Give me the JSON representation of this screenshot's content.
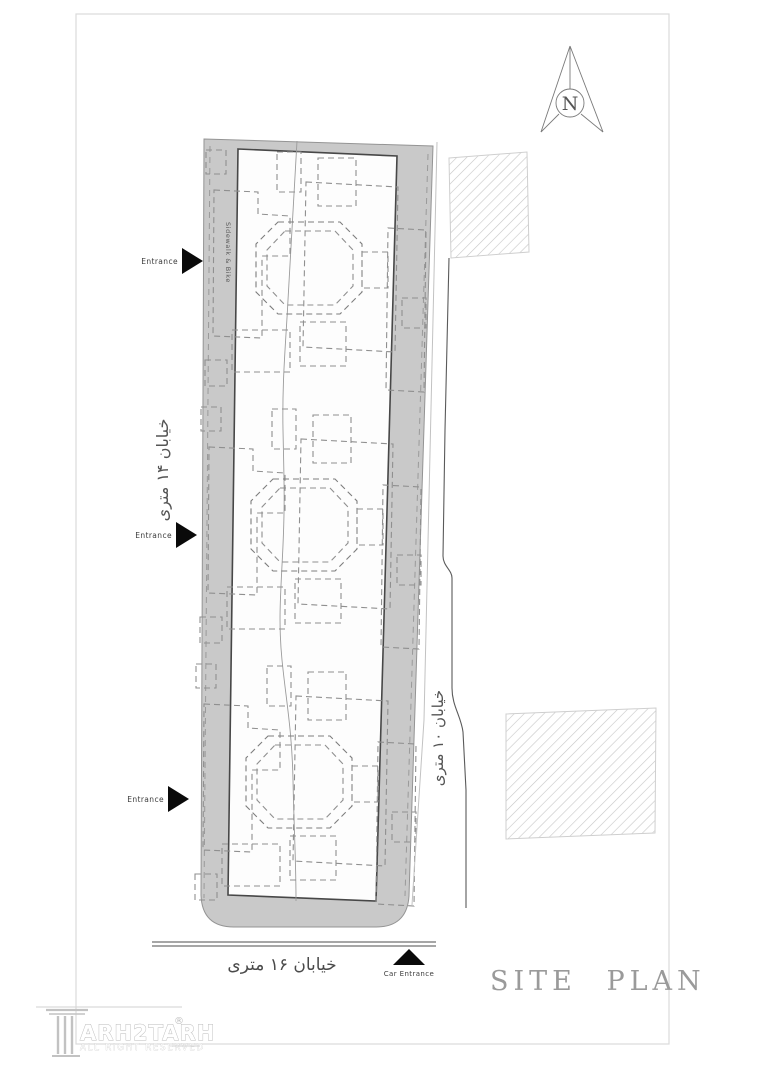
{
  "drawing": {
    "title": "SITE PLAN",
    "compass_label": "N",
    "streets": {
      "left": "خیابان ۱۴ متری",
      "right": "خیابان ۱۰ متری",
      "bottom": "خیابان ۱۶ متری"
    },
    "sidewalk_label": "Sidewalk & Bike",
    "entrances": [
      {
        "label": "Entrance"
      },
      {
        "label": "Entrance"
      },
      {
        "label": "Entrance"
      }
    ],
    "car_entrance_label": "Car Entrance",
    "logo": {
      "name": "ARH2TARH",
      "registered": "®",
      "tagline": "ALL RIGHT RESERVED"
    },
    "colors": {
      "sidewalk_fill": "#c9c9c9",
      "band_outline": "#949494",
      "inner_outline": "#474747",
      "dash_gray": "#8f8f8f",
      "hatch": "#c6c6c6",
      "road_dark": "#5a5a5a",
      "title_gray": "#9a9a9a",
      "marker_black": "#0a0a0a"
    }
  }
}
